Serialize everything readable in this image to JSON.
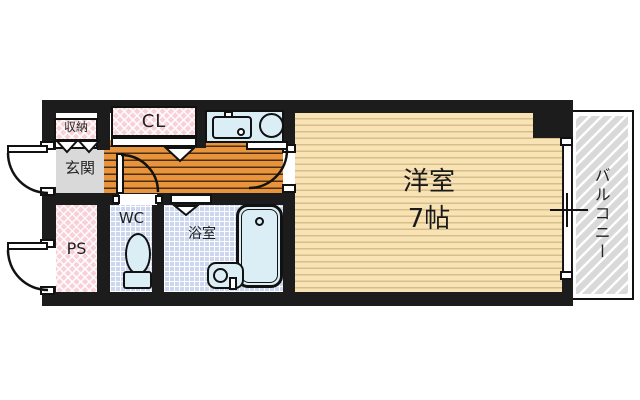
{
  "floorplan": {
    "type": "apartment-1K-floor-plan",
    "rooms": {
      "storage": {
        "label": "収納"
      },
      "closet": {
        "label": "CL"
      },
      "entrance": {
        "label": "玄関"
      },
      "pipe_space": {
        "label": "PS"
      },
      "toilet_room": {
        "label": "WC"
      },
      "bathroom": {
        "label": "浴室"
      },
      "western_room": {
        "label": "洋室",
        "size": "7帖"
      },
      "balcony": {
        "label": "バルコニー"
      }
    },
    "colors": {
      "wall": "#1c1c1c",
      "pink_hatch": "#f8d0d8",
      "hall_wood_floor": "#e8943d",
      "main_room_floor": "#f7e3b4",
      "wet_area_tile": "#ccd6ef",
      "fixture_fill": "#dceef5",
      "entrance_gray": "#d9d9d9",
      "balcony_gray": "#d9d9d9"
    }
  }
}
